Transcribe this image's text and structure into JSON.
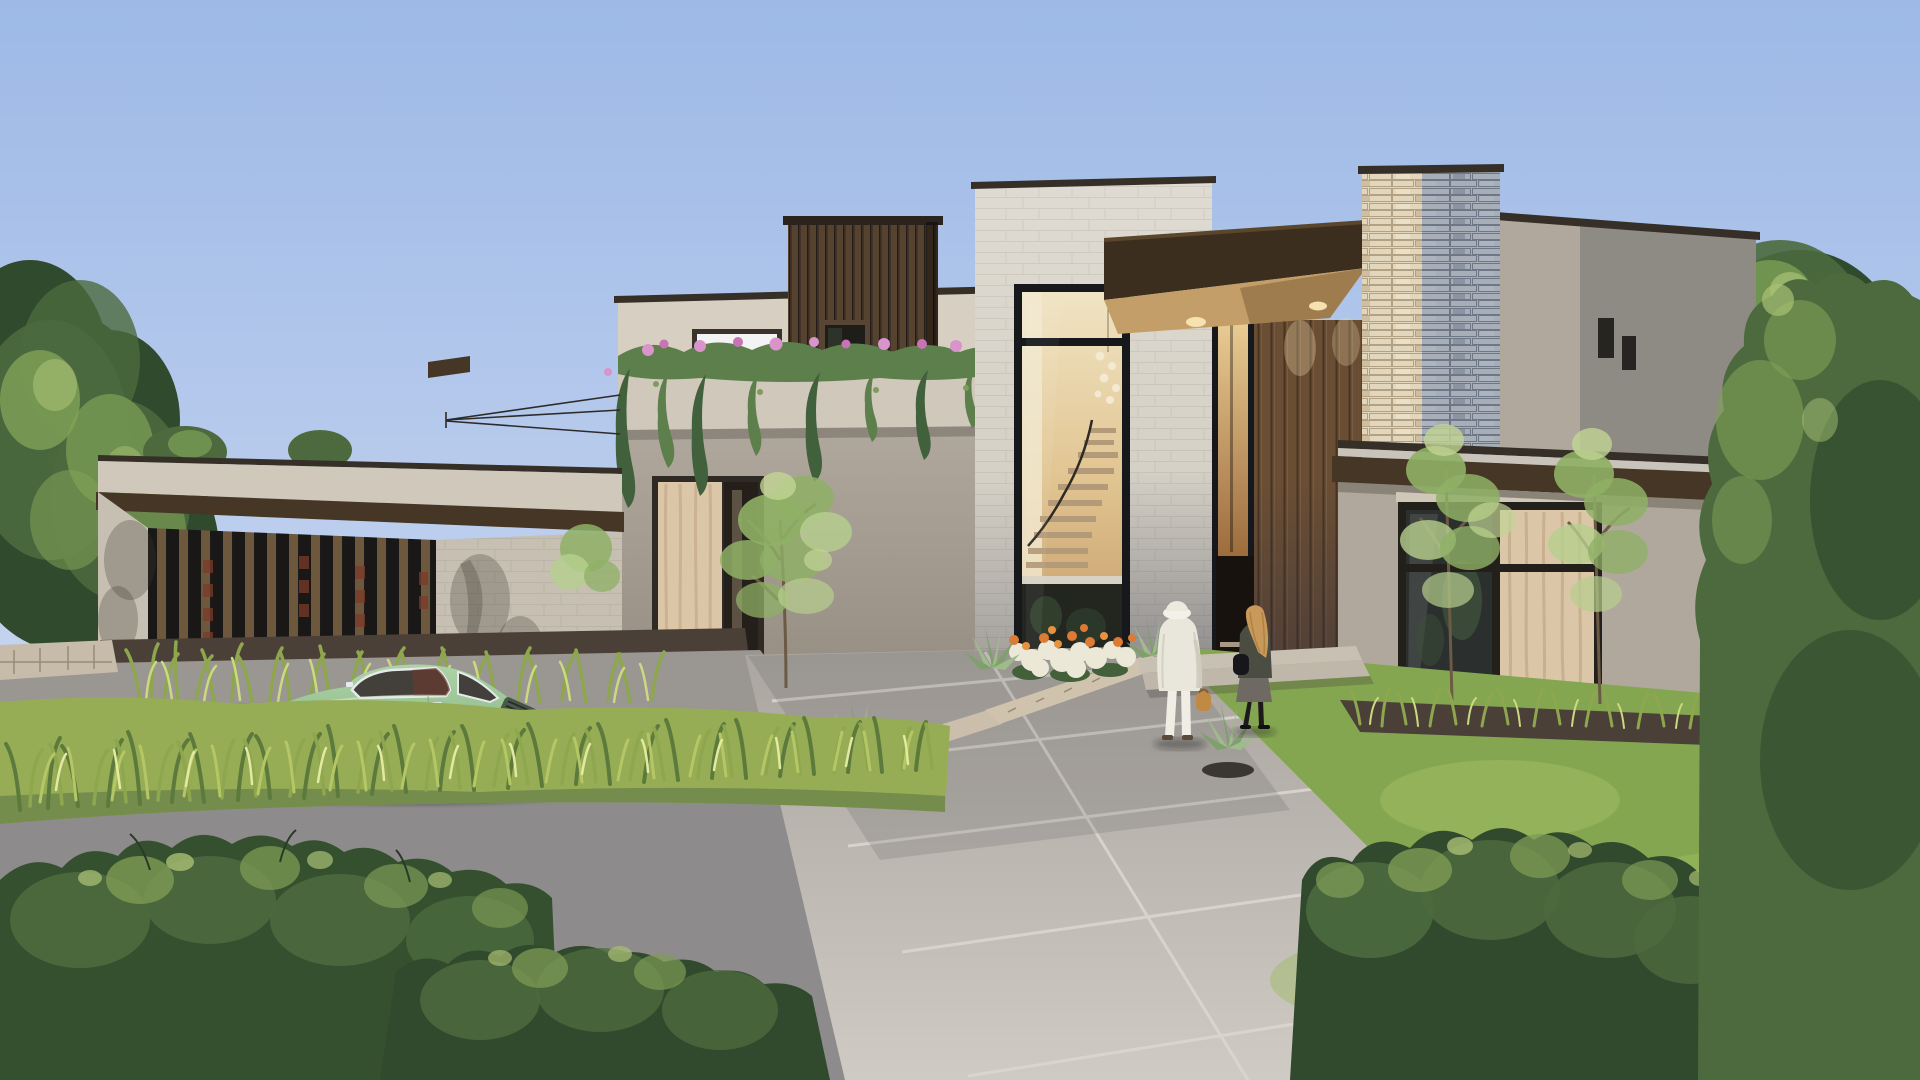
{
  "meta": {
    "type": "architectural-exterior-rendering",
    "description": "Photorealistic daytime rendering of a contemporary flat-roof two-story house with wood slat screens, stacked stone column, double-height glass entry revealing a floating staircase, a pastel green vintage sports coupe parked on the driveway, and two people walking toward the entrance.",
    "width": 1920,
    "height": 1080
  },
  "palette": {
    "sky_top": "#9db9e6",
    "sky_mid": "#b5c9ec",
    "sky_low": "#cdd9ef",
    "tree_dark": "#2f4a2c",
    "tree_mid": "#4c6a3e",
    "tree_light": "#7fa257",
    "tree_bright": "#a9c275",
    "purple_dark": "#53365e",
    "purple_mid": "#6d477c",
    "purple_light": "#8a5f9b",
    "wall_parapet": "#cfc8bb",
    "wall_upper": "#d6cfc2",
    "wall_taupe": "#b0a89c",
    "wall_taupe_dark": "#948c81",
    "wall_shadow": "#8e8a84",
    "wall_shadow2": "#827e78",
    "block_left": "#c6bfb2",
    "roof_cap": "#352f27",
    "wood_fascia": "#463625",
    "slat_base": "#191817",
    "slat_wood": "#6e583d",
    "rust": "#7a3b28",
    "box_base": "#41332a",
    "box_slat": "#55422f",
    "box_cap": "#2b241e",
    "canopy_face": "#3c2e1e",
    "canopy_cap": "#5a462b",
    "soffit": "#c49e68",
    "glow": "#f6e2ae",
    "tower_light": "#dfdbd2",
    "tower_mid": "#cfcabf",
    "glass_frame": "#17181b",
    "interior_top": "#f0e4c4",
    "interior_mid": "#e2c693",
    "interior_low": "#c49a66",
    "tread": "#b39a79",
    "rail": "#2e2a24",
    "slab": "#d8d2c4",
    "interior_base": "#23251f",
    "chandelier": "#f4ead2",
    "slot_top": "#eed29a",
    "slot_low": "#9d6c3c",
    "recess": "#17120e",
    "step_light": "#cbb9a2",
    "entry_slat": "#6a4e34",
    "entry_groove": "#473320",
    "stone_lit": "#e2d6bc",
    "stone_shade": "#a7aeb8",
    "window_dark": "#262521",
    "curtain": "#dbc6a8",
    "curtain_fold": "#c5ad8c",
    "pane_dark": "#2b2f2e",
    "header_board": "#cfc7b8",
    "roof_light": "#c9c4bb",
    "walk_top": "#aaa59e",
    "walk_low": "#cfcbc4",
    "score": "#dad7d0",
    "curb": "#cfc3ad",
    "stonewall": "#c7bcaa",
    "drive": "#9a9792",
    "road": "#8e8b8c",
    "lawn": "#84a651",
    "lawn_light": "#9cbb60",
    "soil": "#4a4038",
    "grassband": "#97ad55",
    "blade_dark": "#5d7a3d",
    "blade_mid": "#8ea74f",
    "blade_light": "#b5c765",
    "blade_pale": "#cdd97f",
    "blade_sun": "#e2e9a0",
    "bush_dark": "#31492c",
    "bush_base": "#35502f",
    "bush_mid": "#4c6a3e",
    "bush_light": "#7e9b55",
    "bush_tip": "#aabf74",
    "vine_dark": "#41603c",
    "vine_mid": "#5d7f4b",
    "vine_light": "#7f9b5e",
    "flower_pink": "#d995cb",
    "flower_pink_dark": "#c873b6",
    "flower_white": "#ece8d8",
    "flower_orange": "#dd7a33",
    "flower_orange2": "#e8923f",
    "agave": "#9fba8b",
    "agave_dark": "#7fa06c",
    "bowl": "#3a3633",
    "trunk": "#6b5a44",
    "leaf_light": "#b7cf8d",
    "leaf_mid": "#8fb065",
    "leaf_pale": "#c2d494",
    "car_top": "#aed2a6",
    "car_mid": "#93c092",
    "car_low": "#6f9c74",
    "car_glass": "#43403c",
    "car_interior": "#66392f",
    "chrome": "#e6eaec",
    "tire": "#26292c",
    "hub": "#cfd5d8",
    "tail": "#b8453a",
    "wheel_well": "#20241f",
    "coat": "#e9e6db",
    "hat": "#f2f0e8",
    "pants": "#efede4",
    "bag": "#c08a45",
    "shoe": "#5a4a3c",
    "hair": "#c9995c",
    "jacket": "#4b4c42",
    "skirt": "#6e6962",
    "tights": "#1c1a1a",
    "bag_black": "#17161a"
  },
  "scene": {
    "setting": "Modern luxury residence, clear light-blue sky, sunlight from the left",
    "house": {
      "style": "contemporary stacked flat-roof volumes in taupe stucco",
      "elements": [
        "left wing with vertical dark wood slat screen and rust accents",
        "second-floor balcony with cascading vines and pink flowers",
        "dark wood slat box volume with small picture window",
        "double-height limestone block entry tower",
        "glass curtain wall revealing floating wood stair and globe chandelier",
        "deep dark-brown entry canopy with warm wood soffit and downlights",
        "warm lit glass entry slot and recessed front door with steps",
        "stacked stone column, cream in sun and blue-gray in shade",
        "upper taupe volume with two small dark windows",
        "right wing with large gridded window and cream curtain",
        "steel cable trellis over the left wing roof"
      ]
    },
    "vehicle": {
      "type": "vintage sports coupe",
      "color_name": "pastel green",
      "facing": "left",
      "details": [
        "chrome window trim",
        "silver steel wheels",
        "chrome rear bumper",
        "red-brown interior visible through glass"
      ]
    },
    "people": [
      {
        "description": "woman in long white coat and white sun hat carrying a tan handbag, seen from behind walking toward the entry"
      },
      {
        "description": "person with long blonde hair, dark jacket, gray skirt, black crossbody bag, walking beside her"
      }
    ],
    "landscape": [
      "ornamental grasses in front of the slat screen",
      "flower bed of white and orange blooms flanked by agaves",
      "young multi-stem trees by the entry and right wing",
      "golden sunlit grass strip in front of the car",
      "fluffy dark-green foreground hedges",
      "large mature trees on both sides",
      "purple ornamental shrub at far right",
      "agaves in dark bowl planters"
    ],
    "hardscape": [
      "scored light concrete entry walk",
      "gray concrete driveway",
      "asphalt lane in the foreground",
      "low stacked-stone curb along the flower bed",
      "wide shallow entry steps"
    ]
  }
}
